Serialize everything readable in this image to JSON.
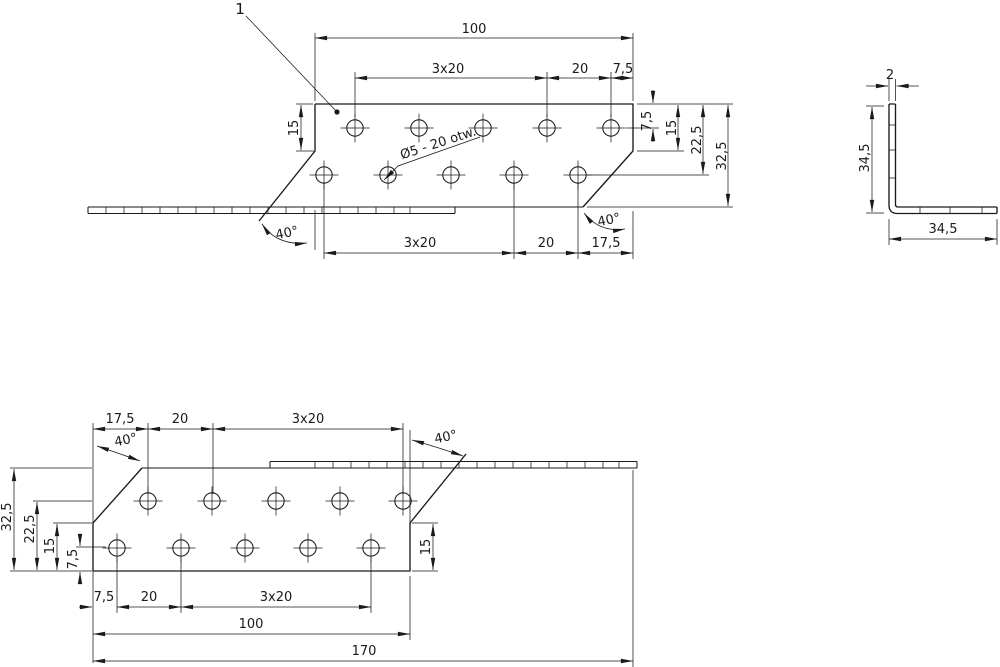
{
  "drawing": {
    "part_label": "1",
    "hole_note": "Ø5 - 20 otw.",
    "line_color": "#1a1a1a",
    "background": "#ffffff",
    "front_view": {
      "dim_overall": "100",
      "dim_row1_pitch": "3x20",
      "dim_row1_gap": "20",
      "dim_row1_edge": "7,5",
      "dim_left_15": "15",
      "dim_right_7_5": "7,5",
      "dim_right_15": "15",
      "dim_right_22_5": "22,5",
      "dim_right_32_5": "32,5",
      "dim_angle_left": "40°",
      "dim_angle_right": "40°",
      "dim_row2_pitch": "3x20",
      "dim_row2_gap": "20",
      "dim_row2_edge": "17,5"
    },
    "side_view": {
      "dim_thickness": "2",
      "dim_height": "34,5",
      "dim_width": "34,5"
    },
    "back_view": {
      "dim_row1_edge": "17,5",
      "dim_row1_gap": "20",
      "dim_row1_pitch": "3x20",
      "dim_angle_left": "40°",
      "dim_angle_right": "40°",
      "dim_left_32_5": "32,5",
      "dim_left_22_5": "22,5",
      "dim_left_15": "15",
      "dim_left_7_5": "7,5",
      "dim_row2_edge": "7,5",
      "dim_row2_gap": "20",
      "dim_row2_pitch": "3x20",
      "dim_length": "100",
      "dim_overall": "170",
      "dim_right_15": "15"
    }
  }
}
